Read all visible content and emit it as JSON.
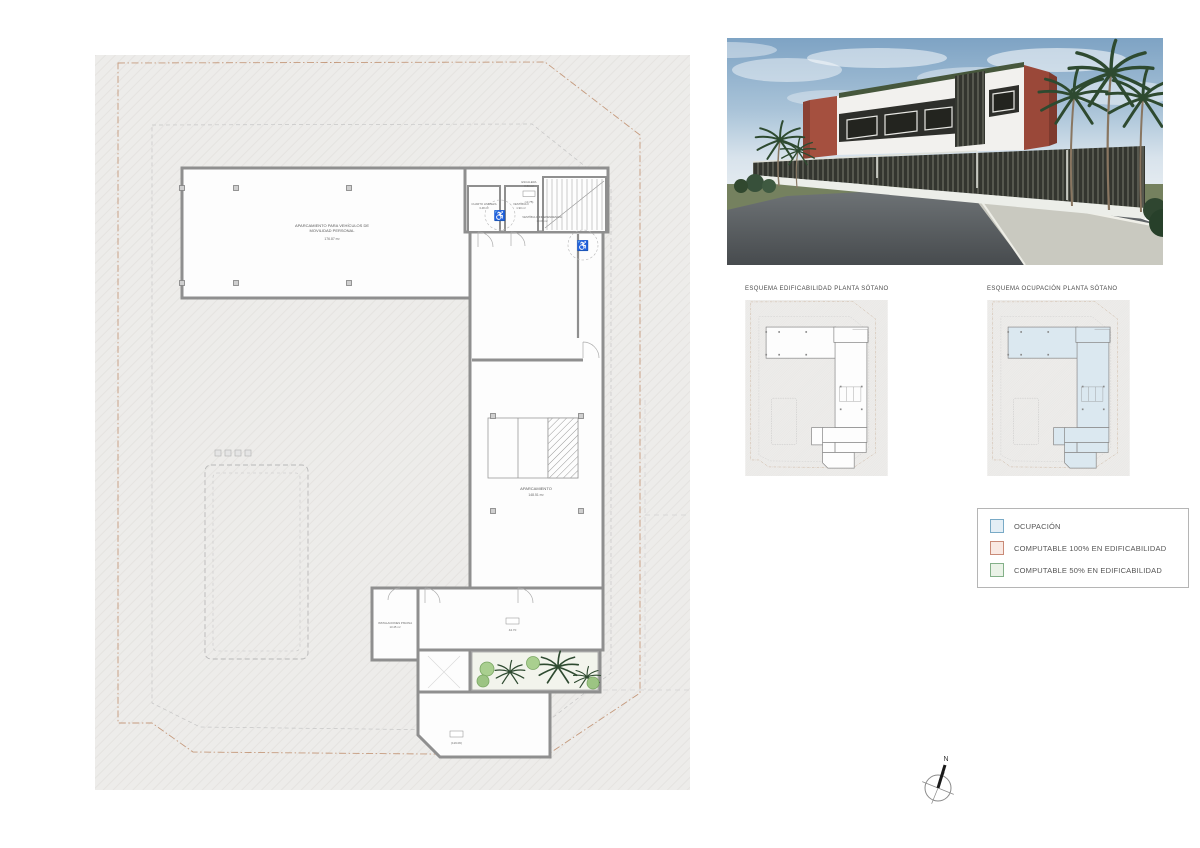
{
  "sheet": {
    "compass_label": "N"
  },
  "main_plan": {
    "rooms": {
      "pmr_parking": {
        "name_line1": "APARCAMIENTO PARA VEHÍCULOS DE",
        "name_line2": "MOVILIDAD PERSONAL",
        "area": "176.87 m²"
      },
      "cleaning": {
        "name": "CUARTO LIMPIEZA",
        "area": "3.48 m²"
      },
      "vestibule": {
        "name": "VESTÍBULO",
        "area": "1.90 m²"
      },
      "stairs": {
        "name": "ESCALERA",
        "area": "8.80 m²"
      },
      "independence_vestibule": {
        "name": "VESTÍBULO INDEPENDENCIA",
        "area": "10.06 m²"
      },
      "parking": {
        "name": "APARCAMIENTO",
        "area": "148.51 m²"
      },
      "pool_plant": {
        "name": "INSTALACIONES PISCINA",
        "area": "13.45 m²"
      }
    },
    "level_markers": {
      "stairs": "(-0.75)",
      "courtyard": "44.70",
      "lower_terrace": "(119.06)"
    }
  },
  "schematics": [
    {
      "title": "ESQUEMA EDIFICABILIDAD PLANTA SÓTANO",
      "footprint_fill": "#fdfdfd"
    },
    {
      "title": "ESQUEMA OCUPACIÓN PLANTA SÓTANO",
      "footprint_fill": "#dbe8f0"
    }
  ],
  "legend": {
    "items": [
      {
        "label": "OCUPACIÓN",
        "swatch_style": "background:#e4eef5;border:1px solid #79aac6"
      },
      {
        "label": "COMPUTABLE 100% EN EDIFICABILIDAD",
        "swatch_style": "background:#f9e9e3;border:1px solid #c98a77"
      },
      {
        "label": "COMPUTABLE 50% EN EDIFICABILIDAD",
        "swatch_style": "background:#eaf2e7;border:1px solid #84b089"
      }
    ]
  },
  "colors": {
    "site_boundary": "#c59a7d",
    "setback_line": "#c6c6c6",
    "walls": "#8f8f8f",
    "occupancy_fill": "#dbe8f0",
    "render_red": "#a5503f",
    "render_dark": "#33352f"
  }
}
